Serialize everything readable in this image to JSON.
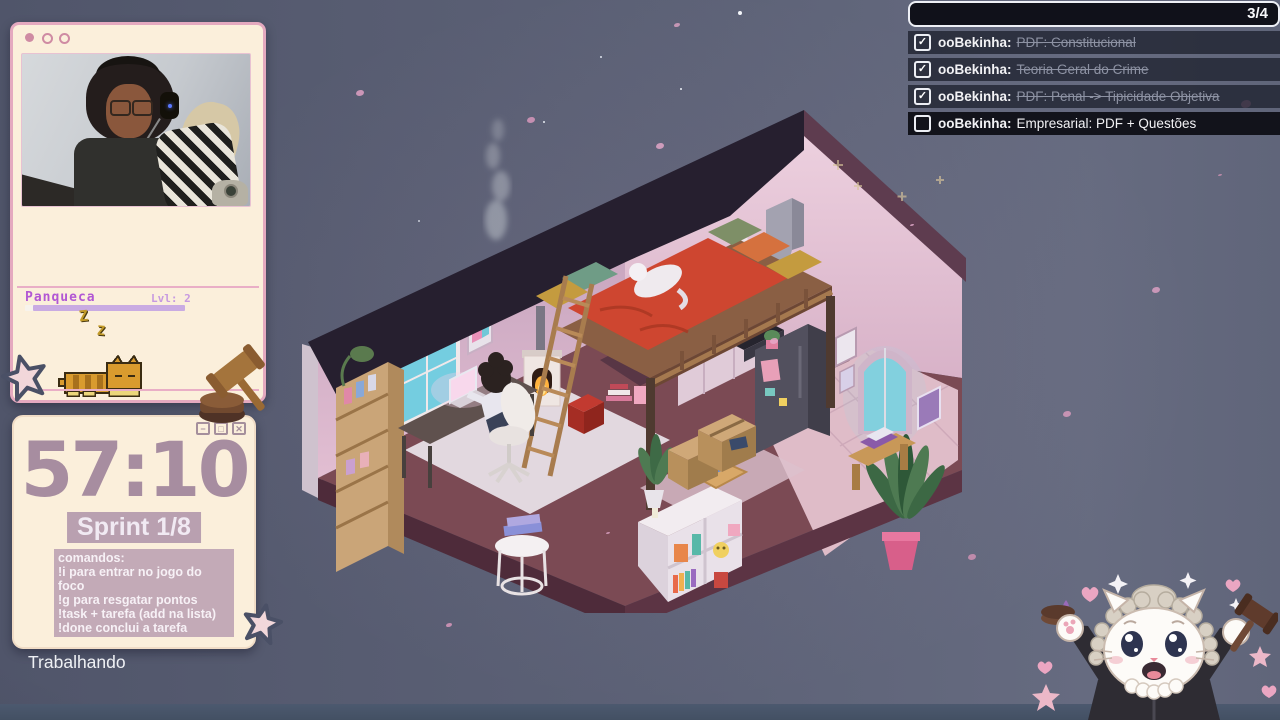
{
  "palette": {
    "background": "#5d6277",
    "bottom_bar": "#47536a",
    "window_cream": "#fbefdb",
    "window_border_pink": "#e4a9bf",
    "timer_mauve": "#a78da0",
    "chip_mauve": "#b9a0b0",
    "pet_purple": "#b257d4",
    "progress_lavender": "#c9abe2",
    "task_row_bg": "rgba(30,33,46,0.78)",
    "task_done_text": "#8d92a3",
    "roof_dark": "#261f2f",
    "wall_pink": "#e6c5d7",
    "blanket_red": "#ce4630",
    "window_teal": "#79cfdd"
  },
  "pet": {
    "name": "Panqueca",
    "level_label": "Lvl: 2",
    "progress_percent": 95,
    "sleep_glyph": "Z"
  },
  "timer_window": {
    "time": "57:10",
    "sprint_label": "Sprint 1/8",
    "controls": {
      "minimize": "−",
      "maximize": "□",
      "close": "✕"
    },
    "commands": {
      "title": "comandos:",
      "lines": [
        "!i para entrar no jogo do foco",
        "!g para resgatar pontos",
        "!task + tarefa (add na lista)",
        "!done conclui a tarefa"
      ]
    }
  },
  "status_text": "Trabalhando",
  "task_list": {
    "counter": "3/4",
    "check_glyph": "✓",
    "items": [
      {
        "user_label": "ooBekinha:",
        "text": "PDF: Constitucional",
        "checked": true
      },
      {
        "user_label": "ooBekinha:",
        "text": "Teoria Geral do Crime",
        "checked": true
      },
      {
        "user_label": "ooBekinha:",
        "text": "PDF: Penal -> Tipicidade Objetiva",
        "checked": true
      },
      {
        "user_label": "ooBekinha:",
        "text": "Empresarial: PDF + Questões",
        "checked": false
      }
    ]
  }
}
